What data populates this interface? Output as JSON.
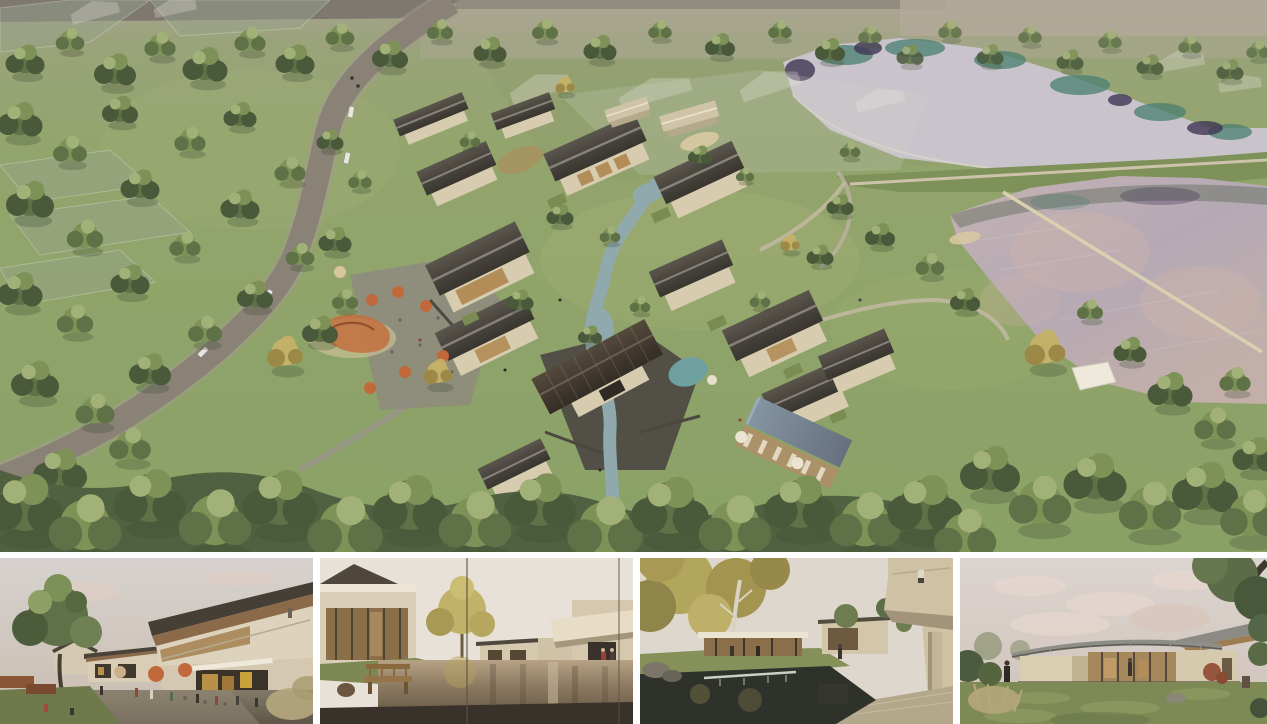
{
  "board": {
    "name": "architectural-rendering-presentation-board"
  },
  "main_render": {
    "name": "aerial-site-render",
    "features": [
      "upper-lake",
      "lake-dike",
      "lower-lake",
      "lake-walkway",
      "access-road",
      "village-buildings",
      "central-hall",
      "stream",
      "swimming-pool",
      "cafe-terrace",
      "playground",
      "event-tent",
      "ghost-phase-buildings",
      "tree-canopy"
    ]
  },
  "thumbnails": [
    {
      "name": "street-cafe-view"
    },
    {
      "name": "courtyard-pond-view"
    },
    {
      "name": "courtyard-waterfall-view"
    },
    {
      "name": "garden-pavilion-view"
    }
  ],
  "colors": {
    "page_bg": "#ffffff",
    "haze": "#aaa294",
    "top_road": "#7e7870",
    "grass_base": "#93a56d",
    "grass_light": "#9cab73",
    "tree_dark": "#49593a",
    "tree_mid": "#5e7147",
    "tree_light": "#7e9257",
    "tree_pale": "#a2b178",
    "tree_gold": "#c4b168",
    "tree_gold_dark": "#9c8948",
    "lake_upper": "#c9c3cb",
    "reflect_teal": "#4a7f70",
    "reflect_purple": "#403655",
    "lake_lower_a": "#c5b3b3",
    "lake_lower_b": "#b5a9b5",
    "lake_pink": "#d4b5a8",
    "dike": "#7e9158",
    "path_light": "#ccc3aa",
    "road": "#8a8177",
    "roof_ridge": "#8d897f",
    "wall_cream": "#d8ccb0",
    "wall_shade": "#b5a98c",
    "glass_warm": "#b38d58",
    "stone_dark": "#4f4b44",
    "stone_light": "#8f8b7f",
    "stream": "#8fa9ad",
    "deck_wood": "#aa9167",
    "umbrella_orange": "#c2693c",
    "car_white": "#e9e7e1",
    "ghost": "#eceae3",
    "sand": "#d9c9a2",
    "t1_sky": "#d7d2cf",
    "t2_sky": "#e7e1d7",
    "t3_sky": "#ded7cd",
    "t4_sky": "#d9d0cb",
    "cloud_pink": "#e3cdc2",
    "pond_dark": "#2e322b",
    "wood_brown": "#8a6a45",
    "soffit_wood": "#97754f",
    "lawn": "#7e8a55",
    "accent_red": "#9a4034"
  }
}
